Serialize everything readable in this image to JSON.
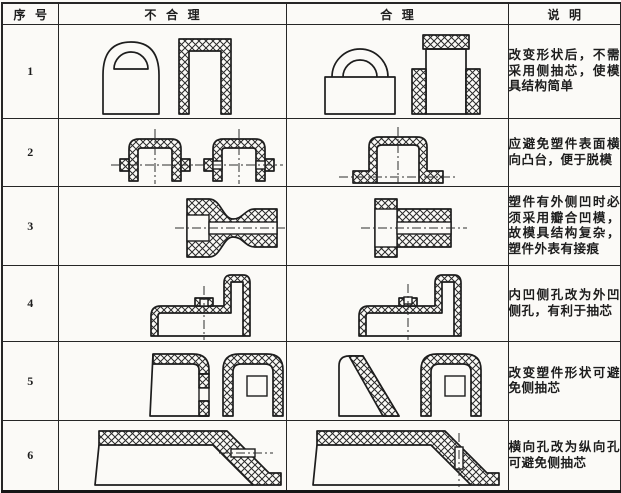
{
  "colors": {
    "ink": "#1d1d1d",
    "paper": "#fbfaf7"
  },
  "table": {
    "headers": {
      "index": "序号",
      "unreasonable": "不合理",
      "reasonable": "合理",
      "note": "说明"
    },
    "rows": [
      {
        "no": "1",
        "note": "改变形状后，不需采用侧抽芯，使模具结构简单"
      },
      {
        "no": "2",
        "note": "应避免塑件表面横向凸台，便于脱模"
      },
      {
        "no": "3",
        "note": "塑件有外侧凹时必须采用瓣合凹模，故模具结构复杂，塑件外表有接痕"
      },
      {
        "no": "4",
        "note": "内凹侧孔改为外凹侧孔，有利于抽芯"
      },
      {
        "no": "5",
        "note": "改变塑件形状可避免侧抽芯"
      },
      {
        "no": "6",
        "note": "横向孔改为纵向孔可避免侧抽芯"
      }
    ]
  }
}
